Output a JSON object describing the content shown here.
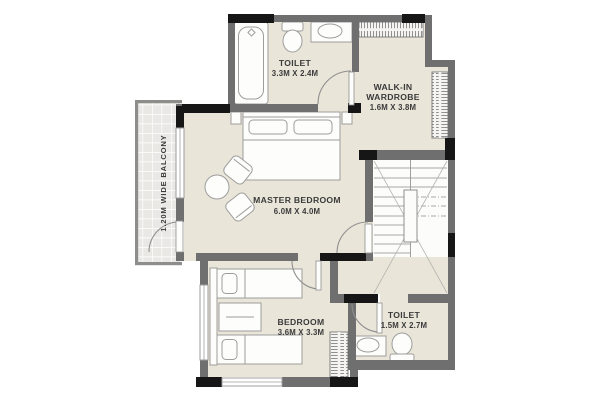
{
  "floor_plan": {
    "balcony": {
      "label": "1.20M WIDE  BALCONY"
    },
    "toilet_top": {
      "name": "TOILET",
      "dims": "3.3M X 2.4M"
    },
    "walkin_wardrobe": {
      "line1": "WALK-IN",
      "line2": "WARDROBE",
      "dims": "1.6M X 3.8M"
    },
    "master_bedroom": {
      "name": "MASTER BEDROOM",
      "dims": "6.0M X 4.0M"
    },
    "bedroom": {
      "name": "BEDROOM",
      "dims": "3.6M X 3.3M"
    },
    "toilet_bottom": {
      "name": "TOILET",
      "dims": "1.5M X 2.7M"
    },
    "colors": {
      "floor": "#eae5d9",
      "wall": "#6f6f6f",
      "wall_dark": "#161616",
      "balcony_tile": "#e9e8e4",
      "fixture_outline": "#9d9d9d"
    }
  }
}
